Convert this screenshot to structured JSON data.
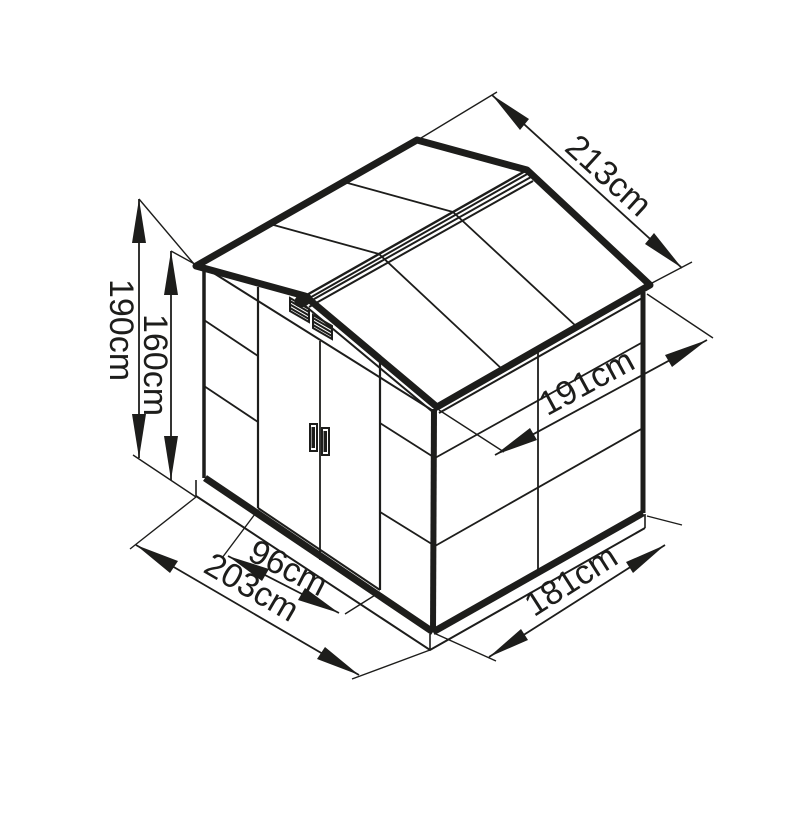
{
  "diagram": {
    "subject": "garden-shed-isometric-dimension-drawing",
    "unit": "cm",
    "line_color": "#1d1d1b",
    "background_color": "#ffffff",
    "dimensions": {
      "ridge_height": {
        "label": "190cm",
        "value": 190
      },
      "eave_height": {
        "label": "160cm",
        "value": 160
      },
      "roof_width": {
        "label": "213cm",
        "value": 213
      },
      "wall_depth": {
        "label": "191cm",
        "value": 191
      },
      "door_width": {
        "label": "96cm",
        "value": 96
      },
      "base_width": {
        "label": "203cm",
        "value": 203
      },
      "base_depth": {
        "label": "181cm",
        "value": 181
      }
    }
  }
}
